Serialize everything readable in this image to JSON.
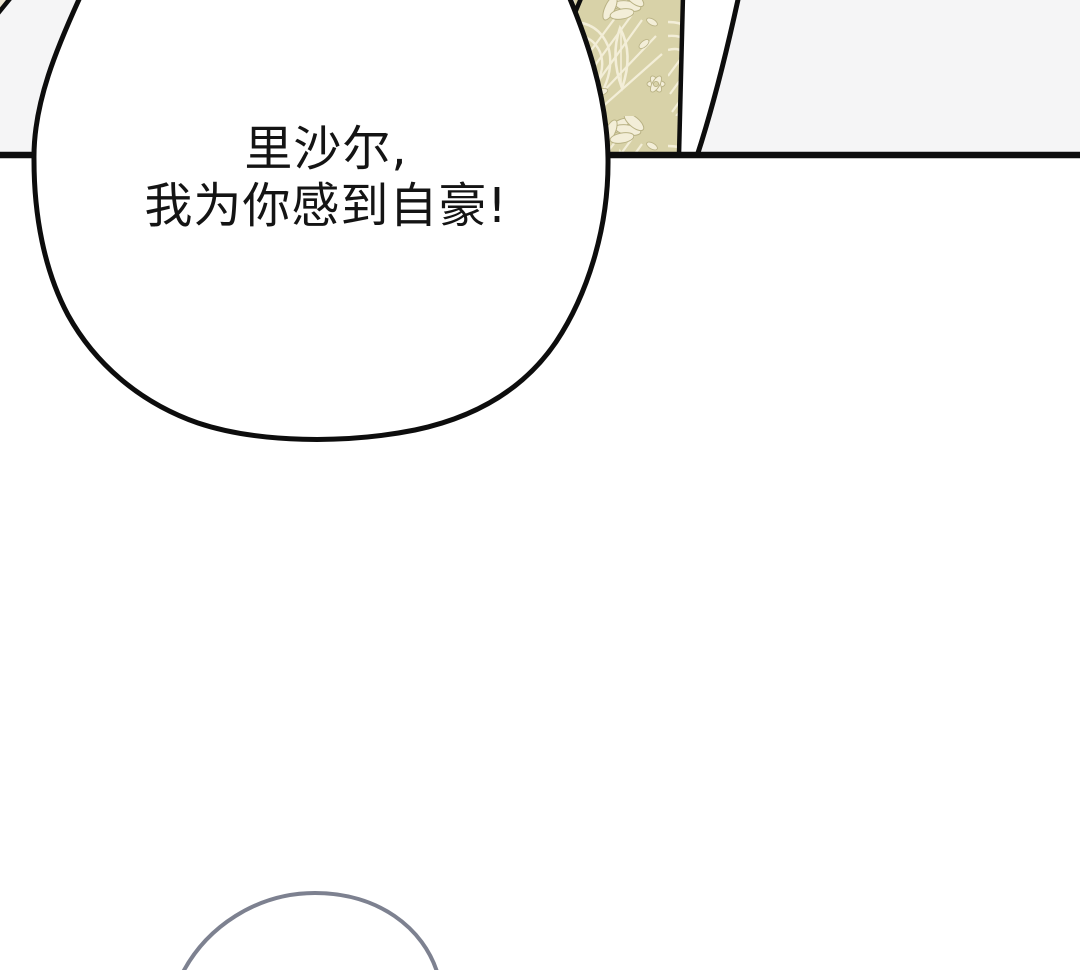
{
  "bubble": {
    "line1": "里沙尔,",
    "line2": "我为你感到自豪!"
  },
  "colors": {
    "background_white": "#ffffff",
    "panel_band_gray": "#f5f5f6",
    "line_black": "#0d0d0d",
    "pattern_base_khaki": "#d8d2a8",
    "pattern_motif_cream": "#f3eed8",
    "pattern_outline_olive": "#b9b284",
    "corner_beige": "#ece5d2",
    "arc_gray": "#7d8190",
    "text_black": "#141414"
  }
}
